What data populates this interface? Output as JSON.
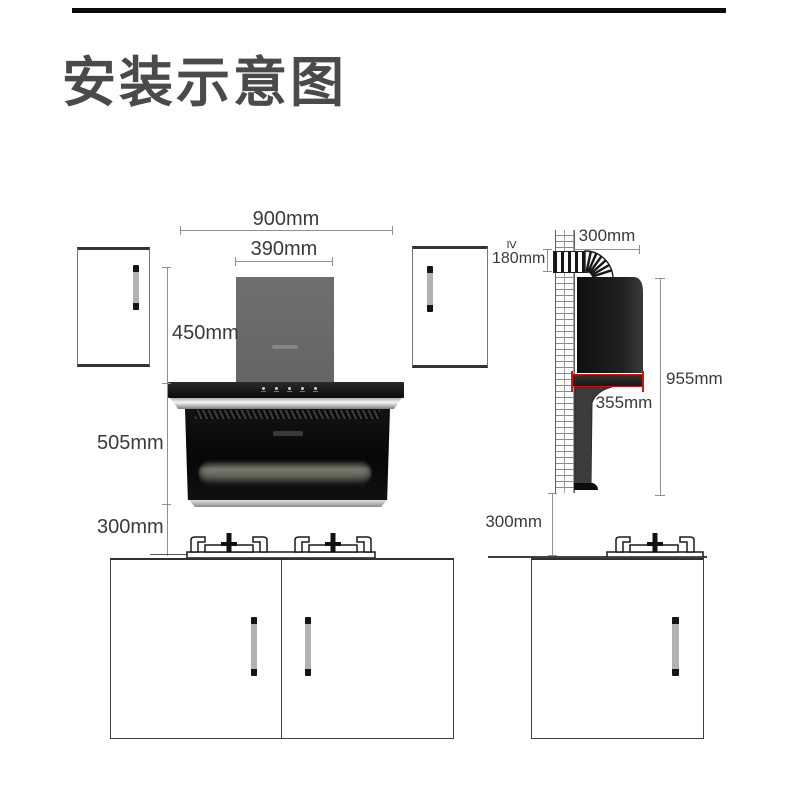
{
  "title": "安装示意图",
  "front_view": {
    "overall_width": "900mm",
    "chimney_width": "390mm",
    "chimney_height": "450mm",
    "body_height": "505mm",
    "clearance_to_stove": "300mm"
  },
  "side_view": {
    "duct_offset_width": "300mm",
    "min_prefix": "≥",
    "duct_clearance": "180mm",
    "overall_height": "955mm",
    "body_depth": "355mm",
    "clearance_to_stove": "300mm"
  },
  "colors": {
    "highlight_red": "#d31414",
    "chimney_gray": "#6a6a6a",
    "hood_black": "#0d0d0d",
    "title_color": "#4a4a4a",
    "dim_line_gray": "#909090",
    "dim_text_color": "#3a3a3a"
  }
}
